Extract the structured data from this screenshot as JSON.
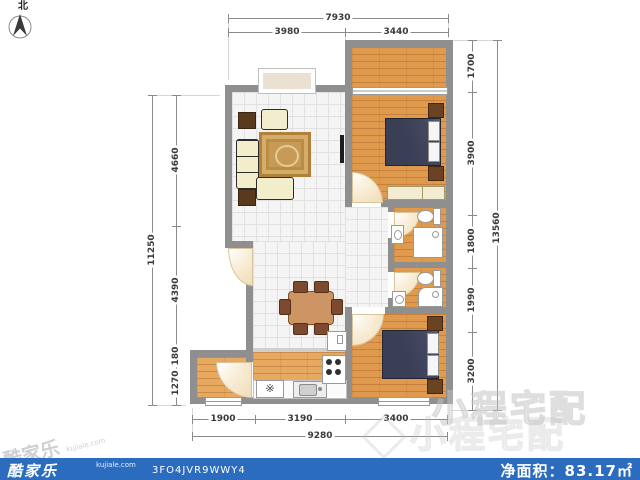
{
  "compass": {
    "north_label": "北"
  },
  "dimensions": {
    "top": {
      "total": "7930",
      "segments": [
        "3980",
        "3440"
      ]
    },
    "bottom": {
      "total": "9280",
      "segments": [
        "1900",
        "3190",
        "3400"
      ]
    },
    "left": {
      "total": "11250",
      "segments": [
        "4660",
        "4390",
        "180",
        "1270"
      ]
    },
    "right": {
      "total": "13560",
      "segments": [
        "1700",
        "3900",
        "1800",
        "1990",
        "3200"
      ]
    }
  },
  "kitchen": {
    "drain_symbol": "※"
  },
  "watermarks": {
    "center_brand": "小程宅配",
    "corner_brand": "酷家乐",
    "corner_domain": "kujiale.com"
  },
  "footer": {
    "brand": "酷家乐",
    "domain": "kujiale.com",
    "code": "3FO4JVR9WWY4",
    "area_text": "净面积：83.17㎡",
    "bar_color": "#2b6cbf"
  },
  "colors": {
    "wall": "#8f8f8f",
    "wood_floor": "#e09a4e",
    "tile_floor": "#f4f4f4",
    "bed": "#3b3f55",
    "footer_bar": "#2b6cbf"
  }
}
